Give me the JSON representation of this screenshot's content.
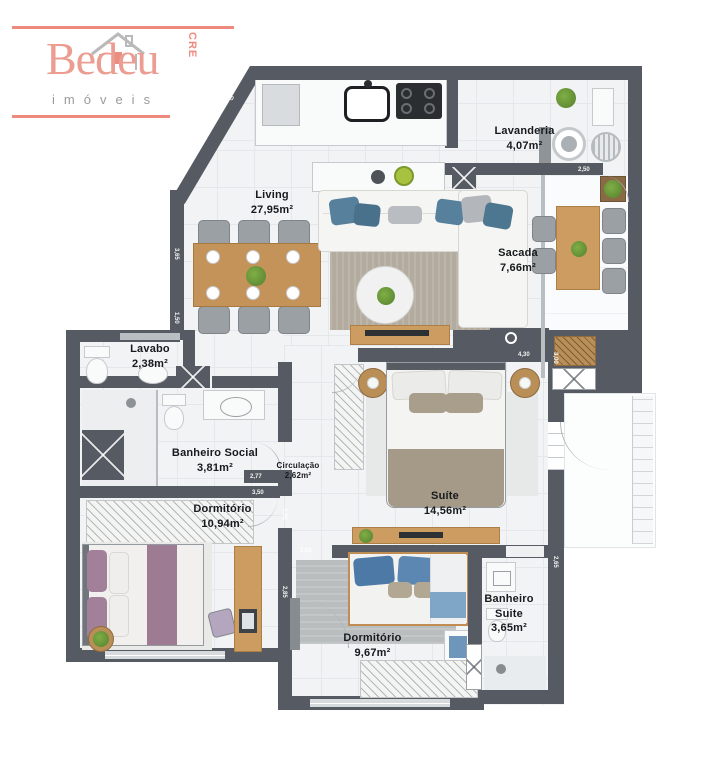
{
  "logo": {
    "brand": "Bedeu",
    "subtitle": "imóveis",
    "creci": "CRECI 665-J"
  },
  "rooms": [
    {
      "name": "Living",
      "area": "27,95m²"
    },
    {
      "name": "Lavanderia",
      "area": "4,07m²"
    },
    {
      "name": "Sacada",
      "area": "7,66m²"
    },
    {
      "name": "Lavabo",
      "area": "2,38m²"
    },
    {
      "name": "Banheiro Social",
      "area": "3,81m²"
    },
    {
      "name": "Circulação",
      "area": "2,62m²"
    },
    {
      "name": "Dormitório",
      "area": "10,94m²"
    },
    {
      "name": "Suíte",
      "area": "14,56m²"
    },
    {
      "name": "Banheiro Suite",
      "area": "3,65m²"
    },
    {
      "name": "Dormitório",
      "area": "9,67m²"
    }
  ],
  "dimensions": [
    {
      "text": "3,40"
    },
    {
      "text": "3,65"
    },
    {
      "text": "1,50"
    },
    {
      "text": "2,50"
    },
    {
      "text": "3,00"
    },
    {
      "text": "4,30"
    },
    {
      "text": "2,65"
    },
    {
      "text": "2,77"
    },
    {
      "text": "3,50"
    },
    {
      "text": "1,00"
    },
    {
      "text": "3,55"
    },
    {
      "text": "2,85"
    }
  ],
  "colors": {
    "wall": "#565b63",
    "floor_tile": "#f2f3f5",
    "balcony_marble": "#fafbfc",
    "wood": "#c4935a",
    "logo_pink": "#ee8a7e",
    "logo_gray": "#9b9b9b",
    "blue_pillow": "#4d79a6",
    "purple_bedding": "#9d7b92",
    "taupe_bedding": "#a49a87"
  }
}
